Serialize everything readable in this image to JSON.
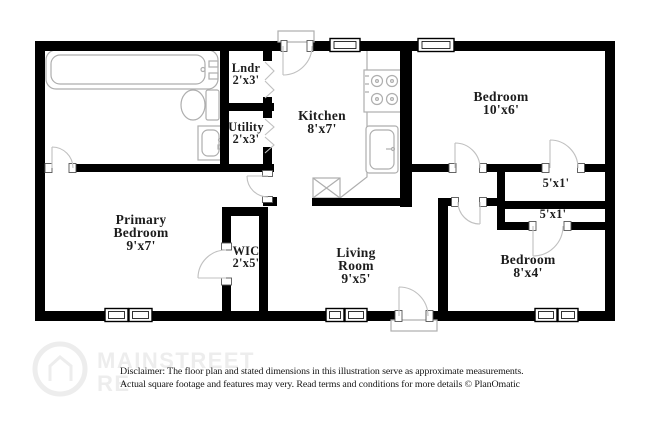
{
  "rooms": {
    "lndr": {
      "name": "Lndr",
      "dims": "2'x3'"
    },
    "utility": {
      "name": "Utility",
      "dims": "2'x3'"
    },
    "kitchen": {
      "name": "Kitchen",
      "dims": "8'x7'"
    },
    "bedroom_top": {
      "name": "Bedroom",
      "dims": "10'x6'"
    },
    "closet_top": {
      "dims": "5'x1'"
    },
    "closet_bottom": {
      "dims": "5'x1'"
    },
    "primary_bedroom": {
      "name_line1": "Primary",
      "name_line2": "Bedroom",
      "dims": "9'x7'"
    },
    "wic": {
      "name": "WIC",
      "dims": "2'x5'"
    },
    "living_room": {
      "name_line1": "Living",
      "name_line2": "Room",
      "dims": "9'x5'"
    },
    "bedroom_right": {
      "name": "Bedroom",
      "dims": "8'x4'"
    }
  },
  "watermark": {
    "line1": "MAINSTREET",
    "line2": "RE"
  },
  "disclaimer": {
    "line1": "Disclaimer: The floor plan and stated dimensions in this illustration serve as approximate measurements.",
    "line2": "Actual square footage and features may very. Read terms and conditions for more details © PlanOmatic"
  },
  "colors": {
    "wall": "#000000",
    "fixture_outline": "#aeaeae",
    "text": "#1c1c1c",
    "watermark": "#ededed"
  }
}
